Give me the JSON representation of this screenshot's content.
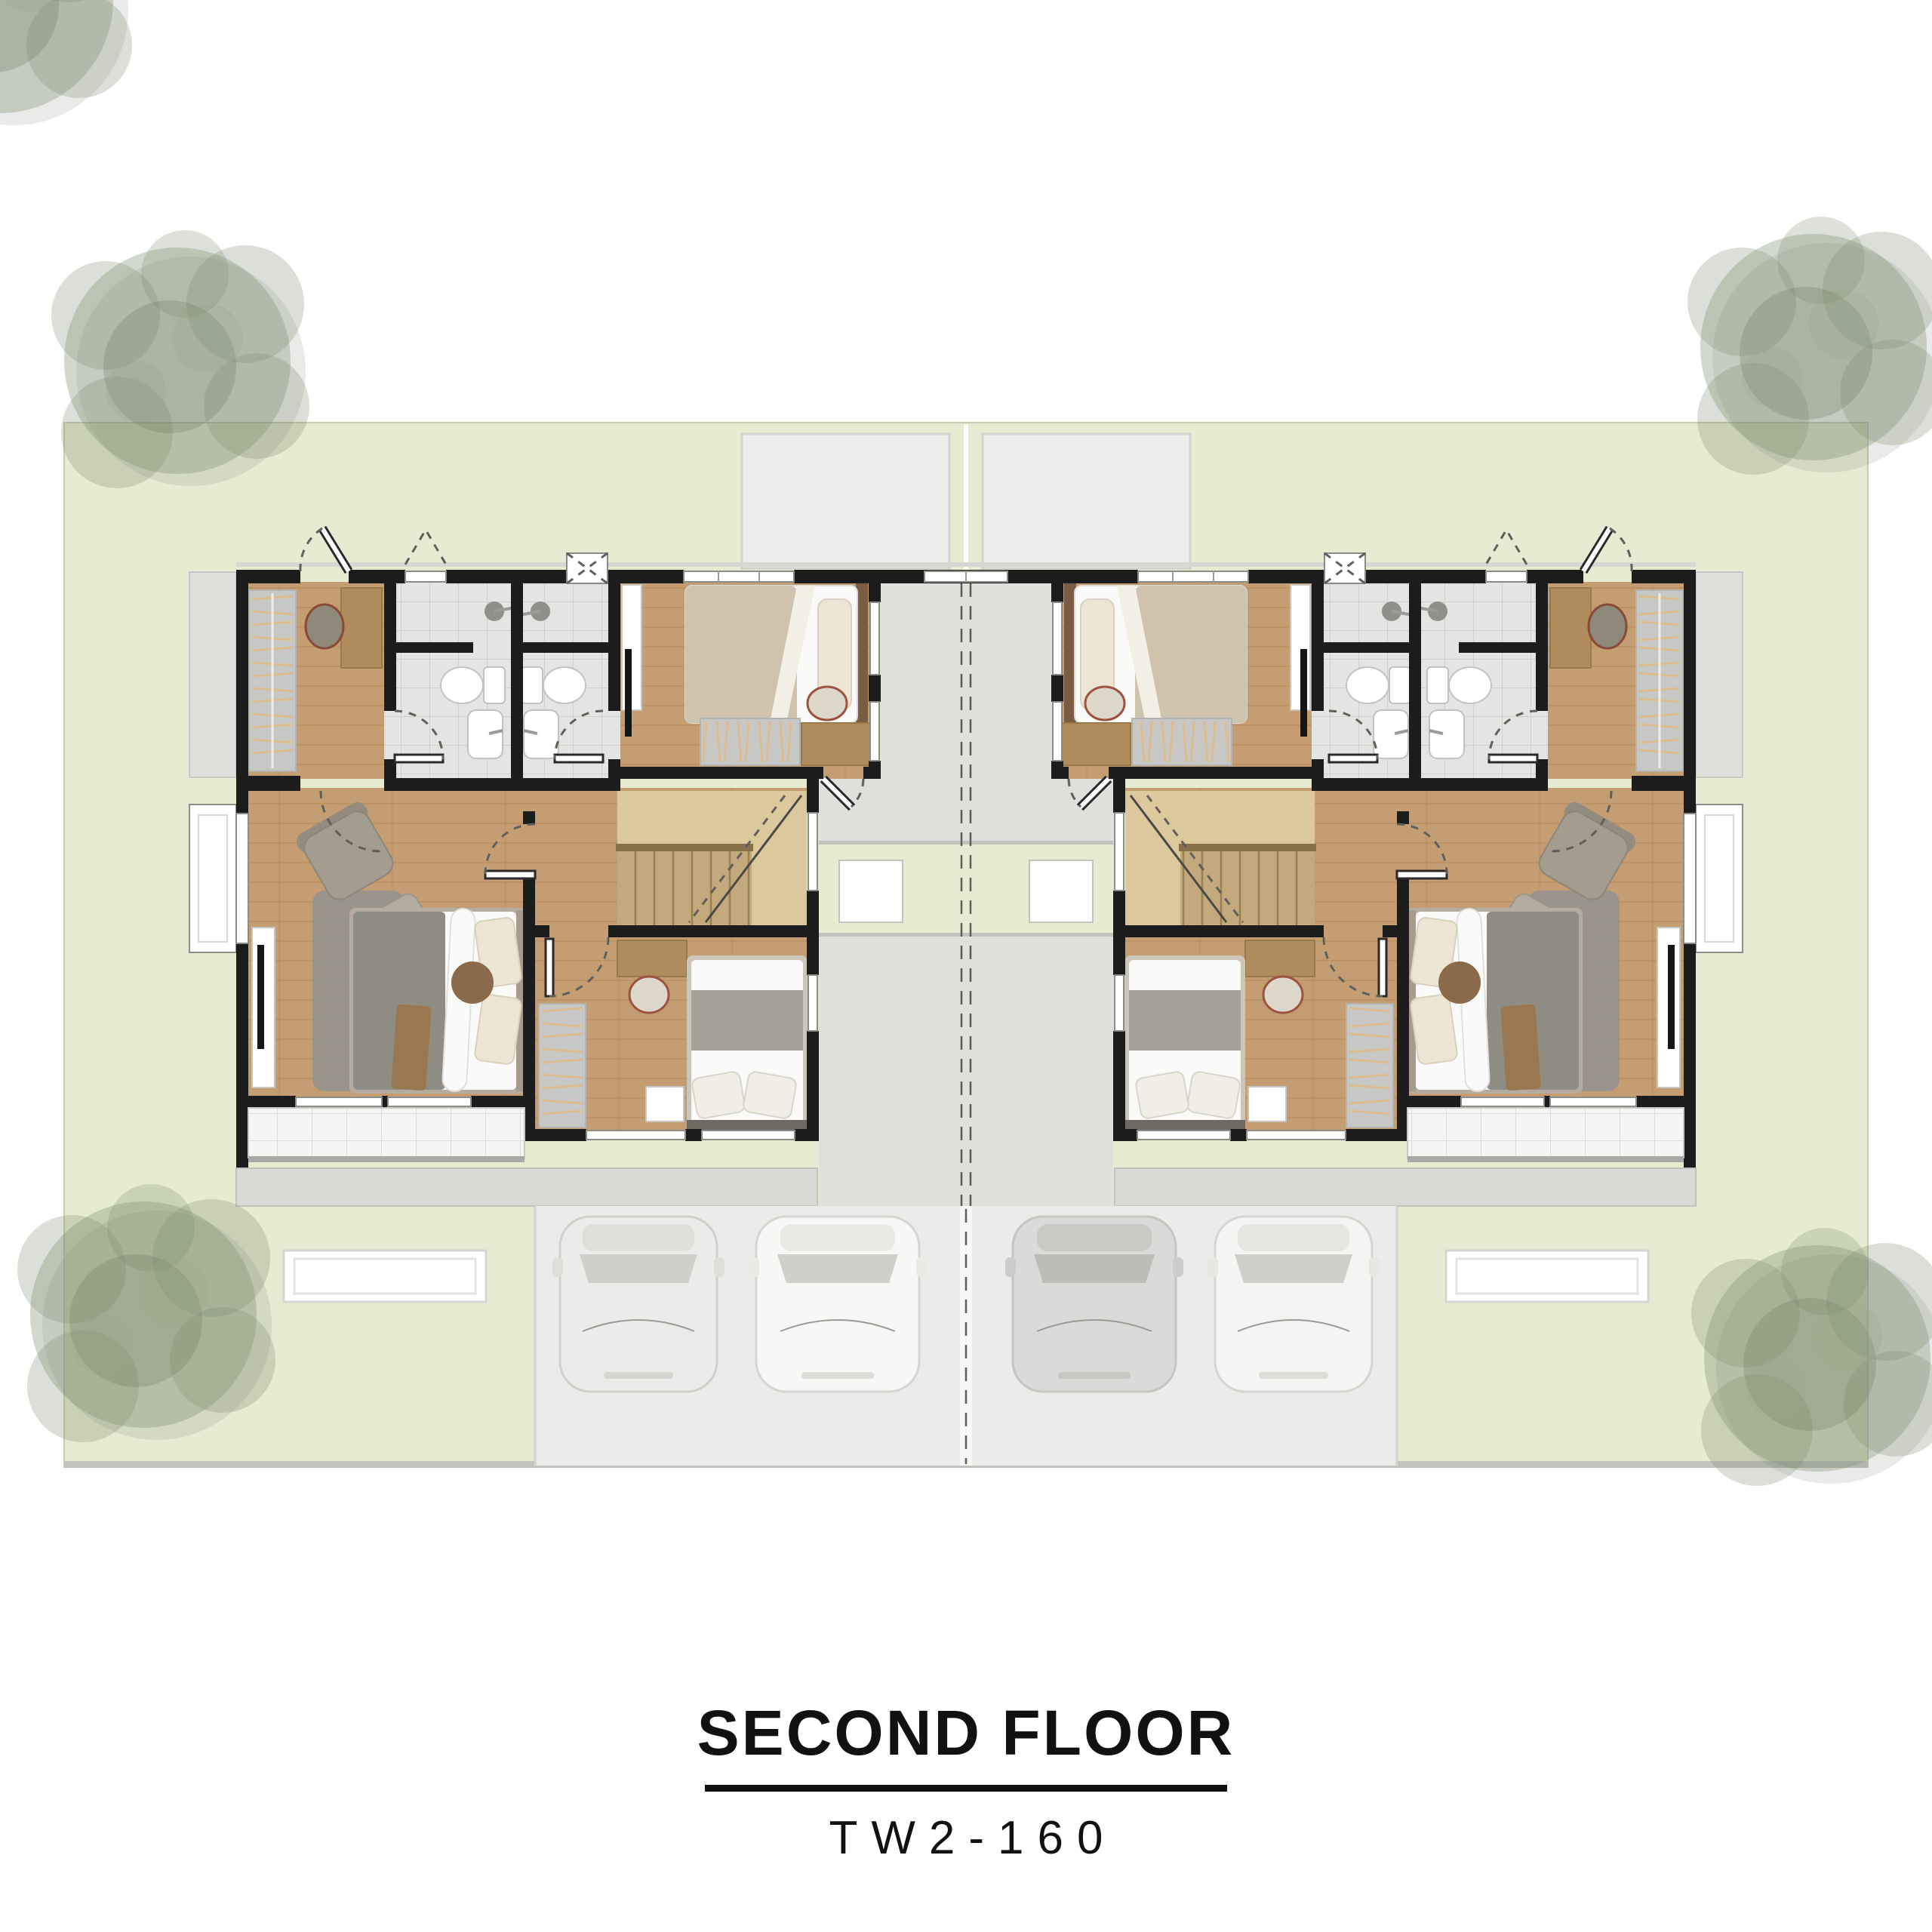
{
  "titleBlock": {
    "heading": "SECOND FLOOR",
    "model": "TW2-160"
  },
  "scene": {
    "units": 2,
    "mirrored": true,
    "trees": 4,
    "cars": 4,
    "ac_pads": 2,
    "entry_canopies": 2,
    "bedrooms_per_unit": 3,
    "bathrooms_per_unit": 2,
    "stairs_per_unit": 1,
    "balconies_per_unit": 2
  },
  "palette": {
    "paper": "#ffffff",
    "ink": "#111111",
    "wall": "#1c1c1c",
    "lawn": "#e6ebd2",
    "lawnLine": "#c8ccb2",
    "wood": "#c59d72",
    "woodLine": "#b28a58",
    "woodLight": "#dcc89d",
    "tread": "#c2aa7d",
    "treadLine": "#97814f",
    "tile": "#e4e4e2",
    "tileLine": "#cfcfcc",
    "concrete": "#dfdfdb",
    "concreteLine": "#c3c3c0",
    "driveway": "#ebebe9",
    "centerStrip": "#f7f7f5",
    "terrace": "#f5f5f3",
    "awning": "#d9d9d6",
    "canopy": "#ededeb",
    "white": "#ffffff",
    "furnGray": "#c7c7c5",
    "hanger": "#dcbd90",
    "bedFrame": "#b5ac9f",
    "duvet": "#fafaf8",
    "blanketGray": "#8f8c83",
    "blanketWarm": "#a7a299",
    "blanketBeige": "#cfc3ae",
    "pillow": "#ece5d4",
    "headboard": "#7a5c43",
    "woodFurn": "#b08c5d",
    "rug": "#95948f",
    "chair": "#a49c8e",
    "tree": "#7d8c6e",
    "treeDark": "#5d6852",
    "carBody": "#f0f0ee",
    "carGlass": "#cfcfcb",
    "dash": "#5f5f5b"
  }
}
